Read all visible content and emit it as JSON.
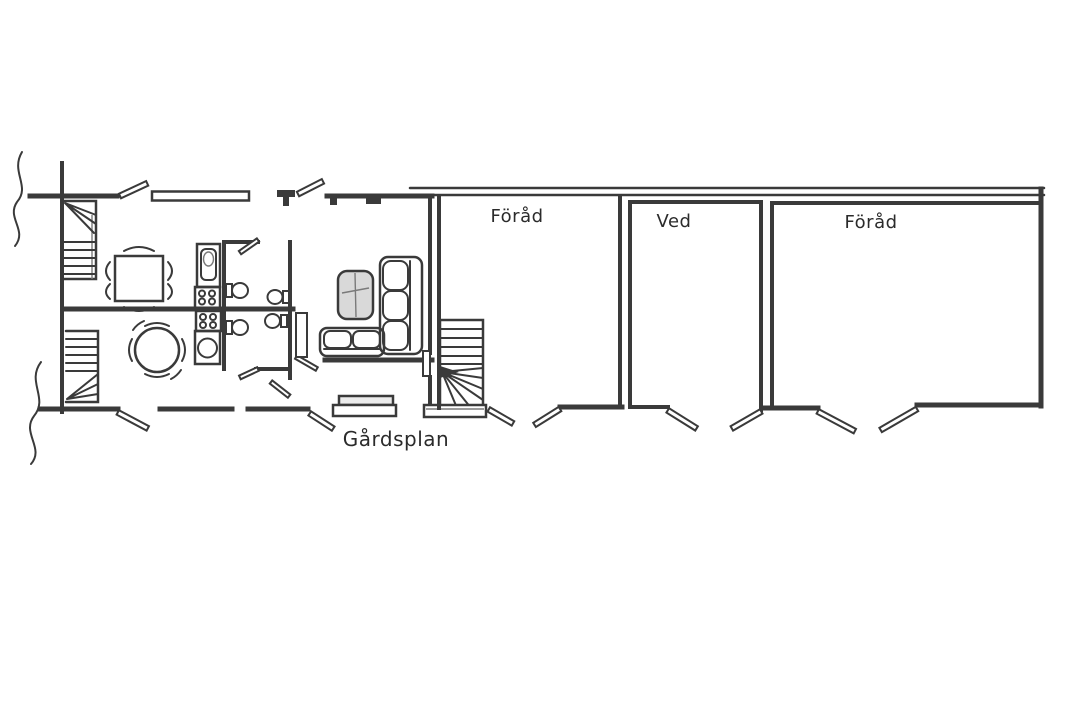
{
  "title": "Hand-drawn floor plan",
  "colors": {
    "paper": "#ffffff",
    "ink": "#3a3a3a",
    "table_fill": "#d9d9d9"
  },
  "rooms": {
    "storage_a": {
      "label": "Föråd"
    },
    "wood_shed": {
      "label": "Ved"
    },
    "storage_b": {
      "label": "Föråd"
    },
    "courtyard": {
      "label": "Gårdsplan"
    }
  },
  "symbols": [
    "break-line",
    "staircase",
    "winder-staircase",
    "dining-table-square",
    "dining-table-round",
    "chair-arc",
    "kitchen-sink",
    "stove-hob",
    "toilet",
    "sofa-three-seat",
    "sofa-two-seat",
    "coffee-table",
    "door-leaf",
    "window",
    "chimney",
    "entrance-steps",
    "stair-landing"
  ]
}
